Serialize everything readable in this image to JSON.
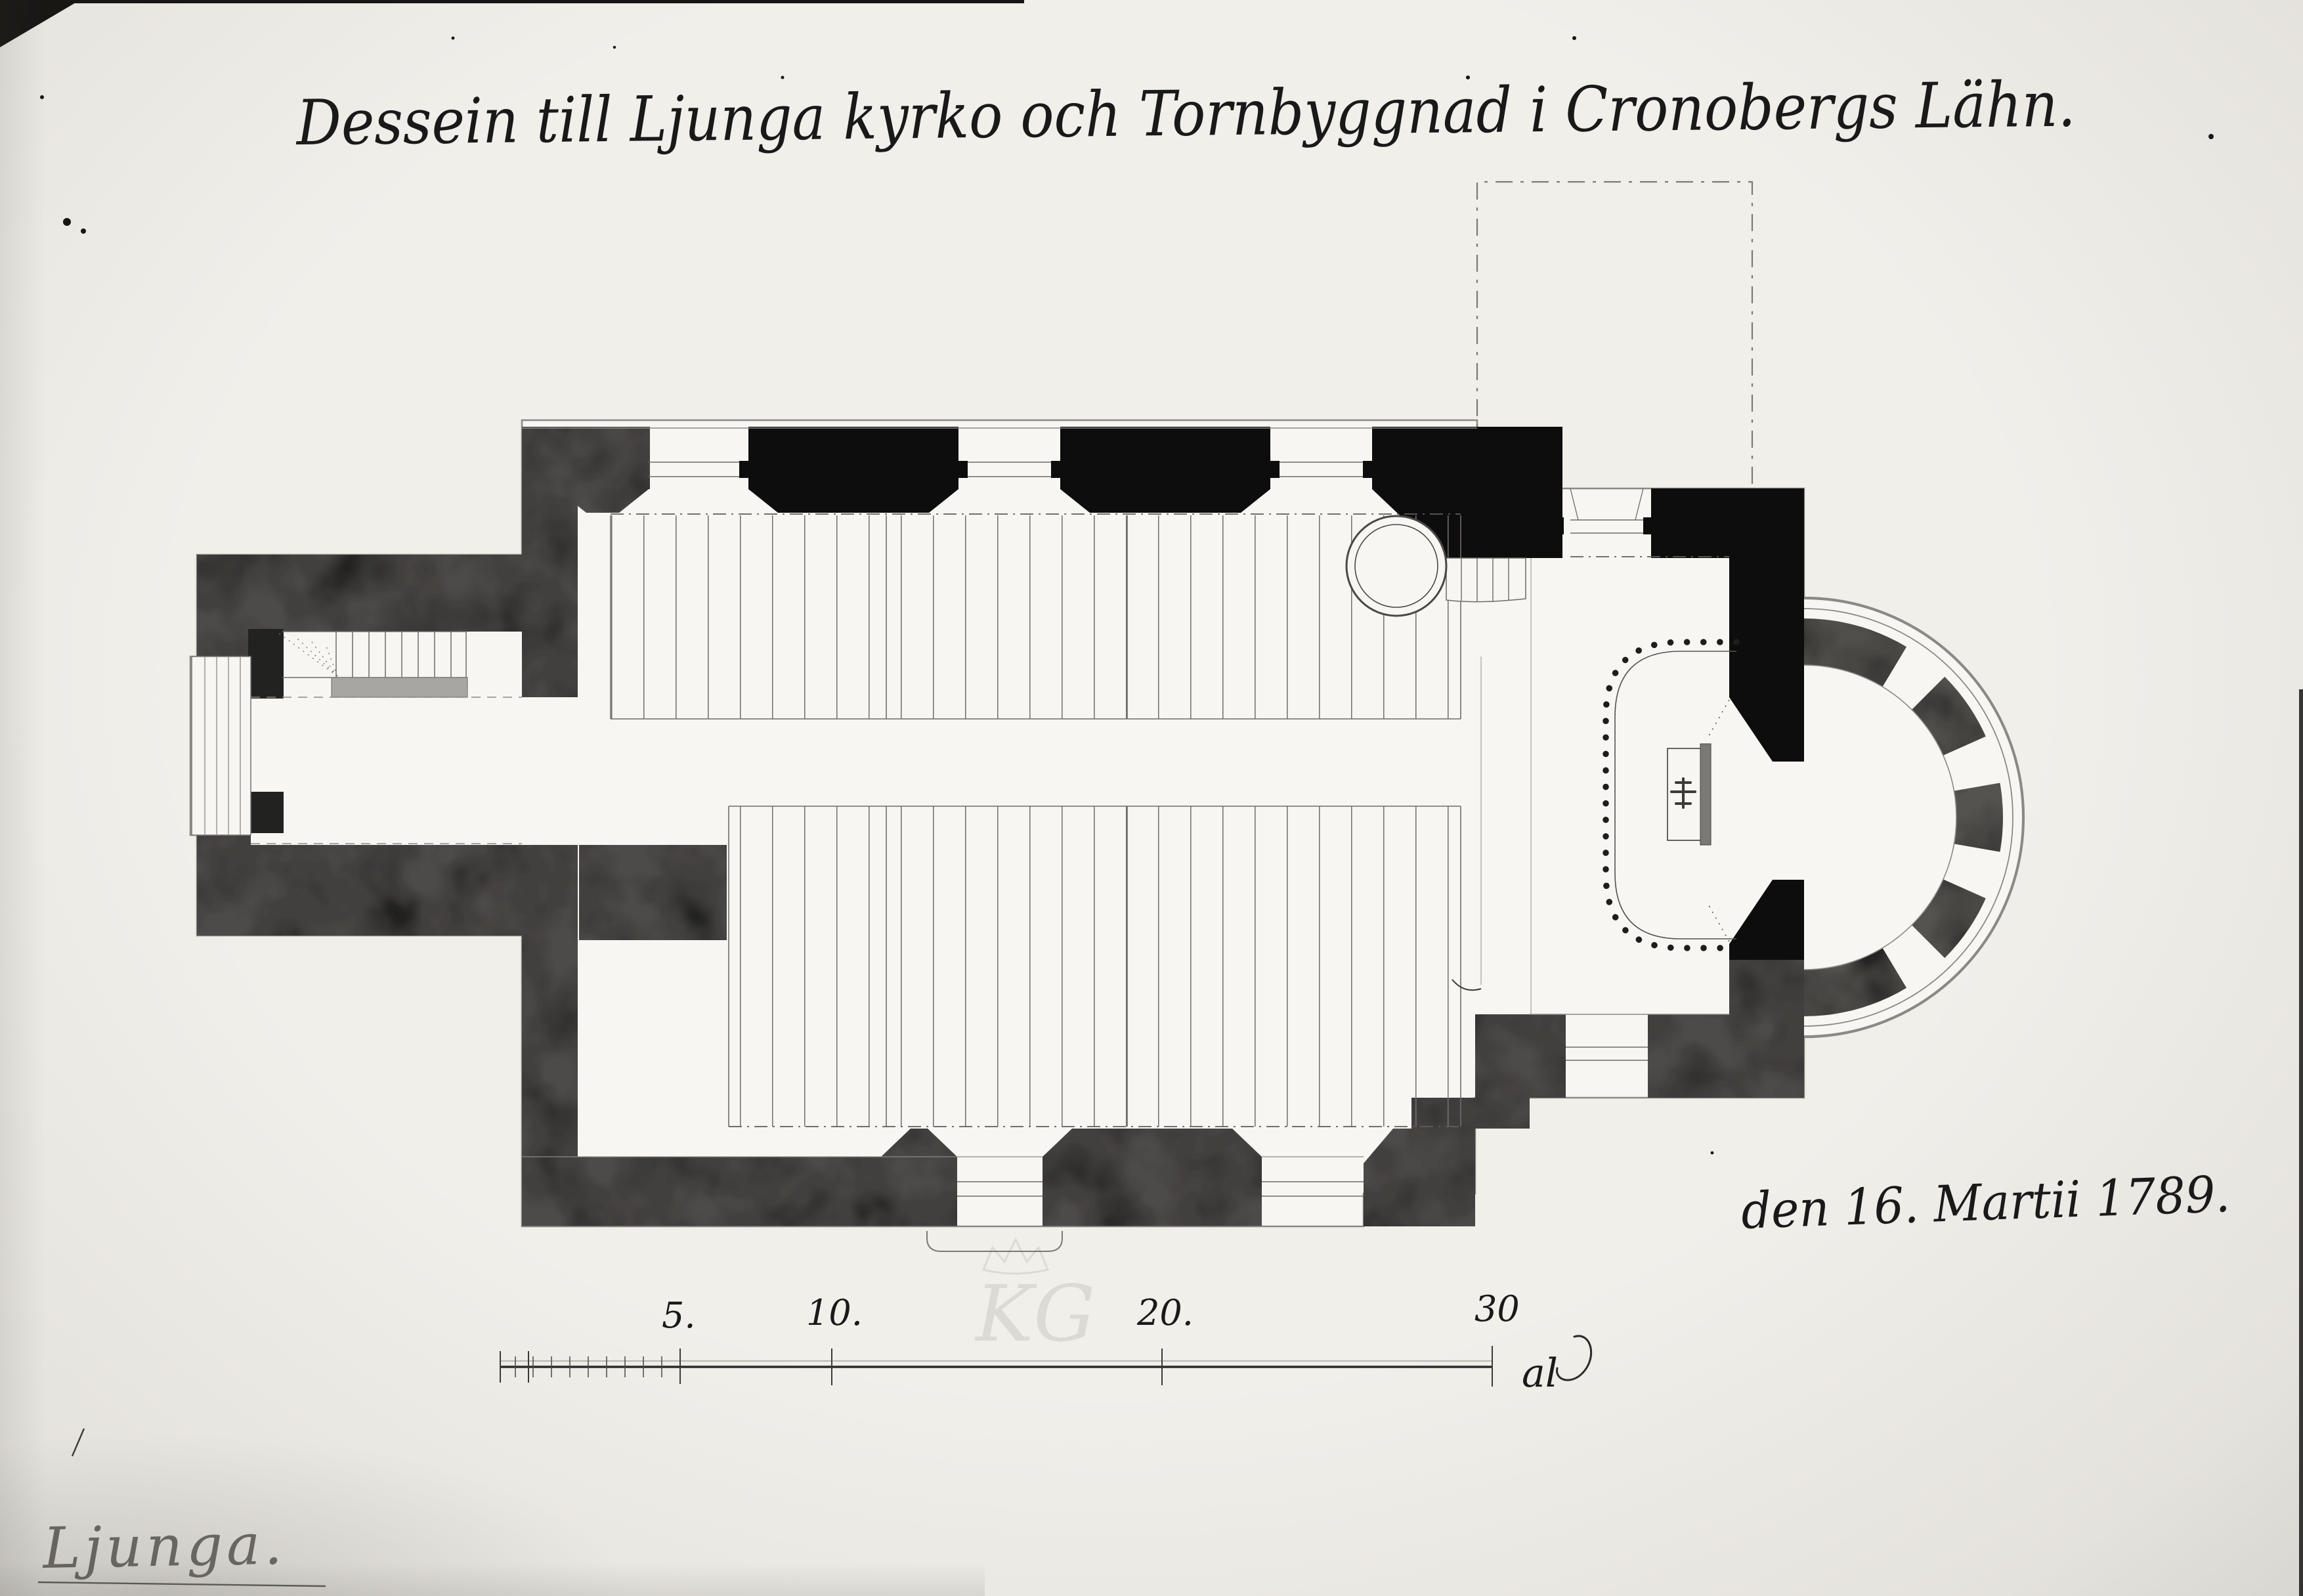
{
  "document": {
    "title_inscription": "Dessein till Ljunga kyrko och Tornbyggnad i Cronobergs Lähn.",
    "date_inscription": "den 16. Martii 1789.",
    "place_label": "Ljunga."
  },
  "scale_bar": {
    "tick_labels": [
      "5.",
      "10.",
      "20.",
      "30"
    ],
    "unit_label": "al"
  },
  "watermark": {
    "monogram": "KG"
  },
  "colors": {
    "paper": "#f1efea",
    "plan_interior": "#f7f6f2",
    "ink_black": "#0d0d0d",
    "wall_wash_gray": "#4d4c4a",
    "pencil_gray": "#6d6b66"
  }
}
